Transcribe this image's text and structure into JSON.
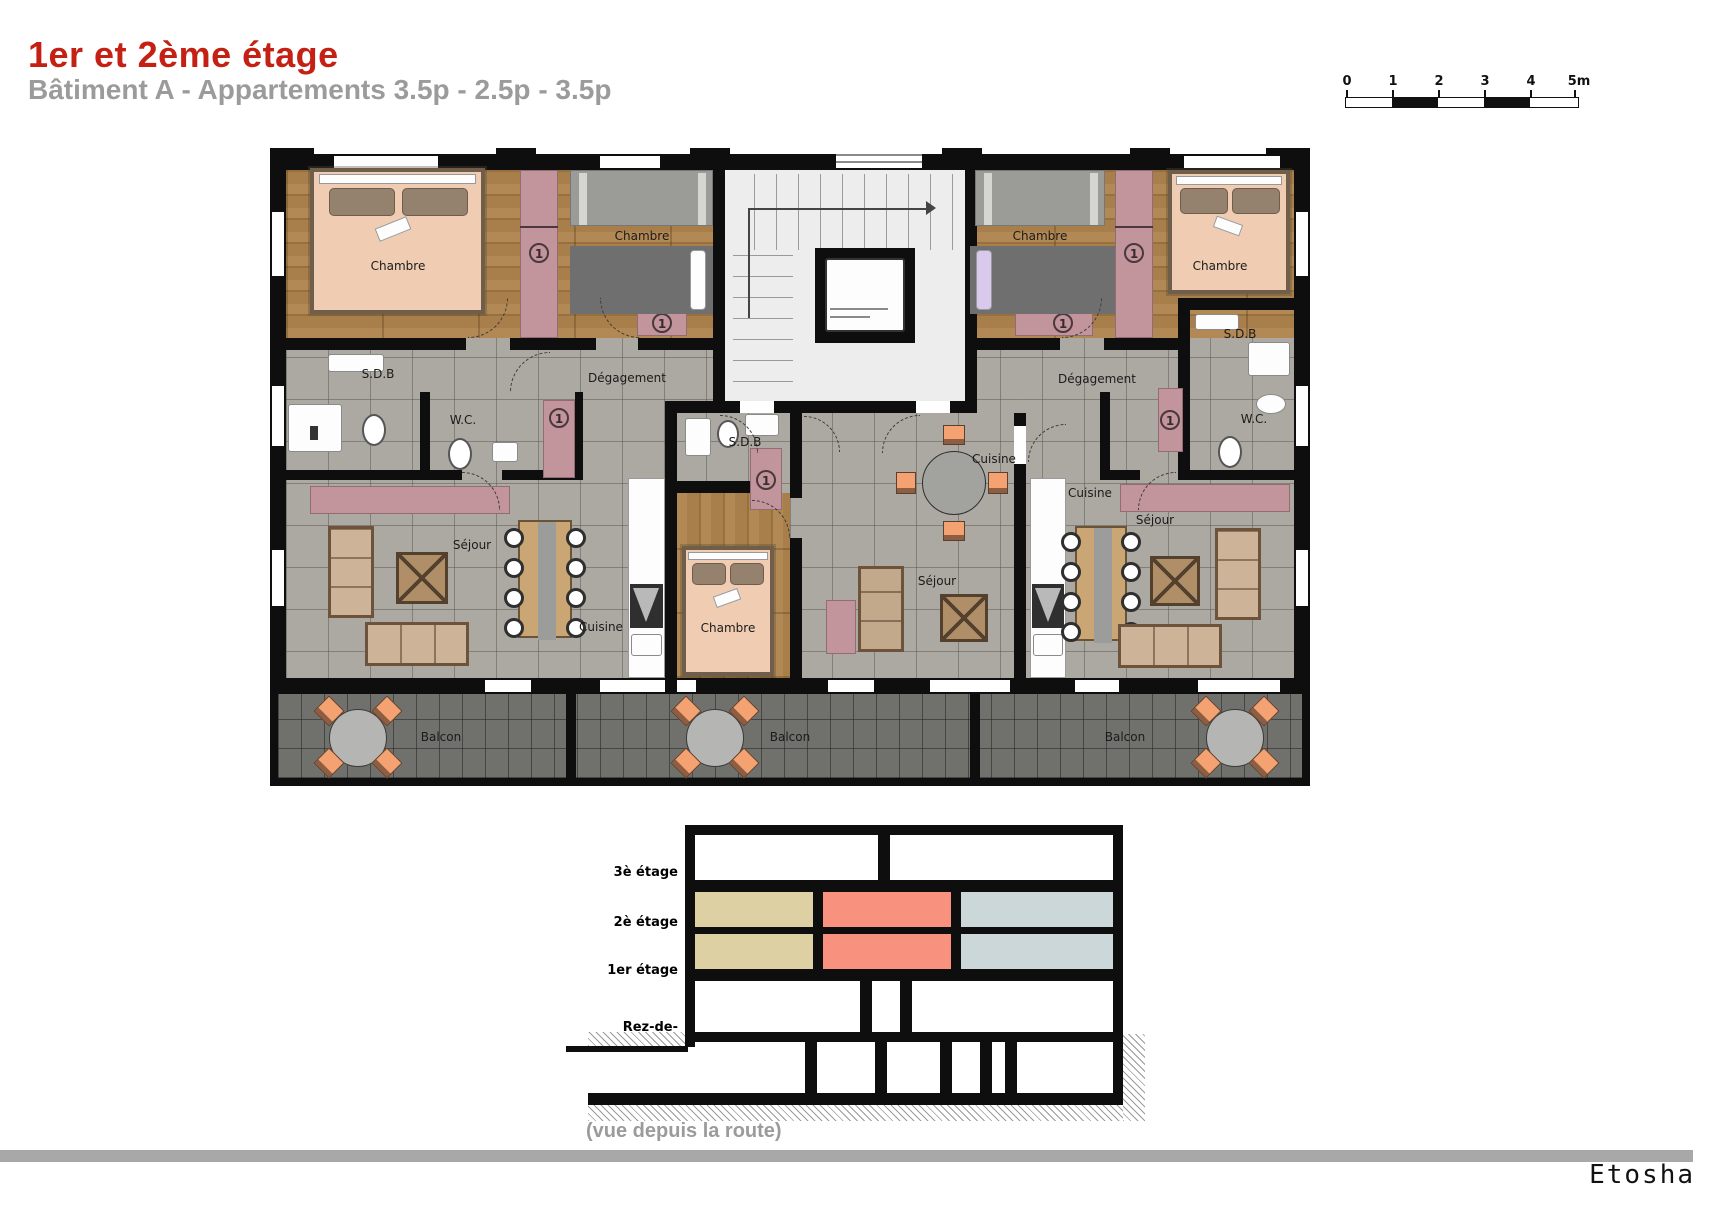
{
  "header": {
    "title": "1er et 2ème étage",
    "subtitle": "Bâtiment A - Appartements 3.5p - 2.5p - 3.5p"
  },
  "scale_bar": {
    "ticks": [
      "0",
      "1",
      "2",
      "3",
      "4",
      "5m"
    ]
  },
  "plan": {
    "labels": {
      "chambre": "Chambre",
      "sdb": "S.D.B",
      "wc": "W.C.",
      "degagement": "Dégagement",
      "sejour": "Séjour",
      "cuisine": "Cuisine",
      "balcon": "Balcon"
    },
    "closet_number": "1"
  },
  "section": {
    "floors": [
      "3è étage",
      "2è étage",
      "1er étage",
      "Rez-de-chaussée"
    ],
    "caption": "(vue depuis la route)",
    "legend_colors": {
      "left_apartment": "#ddd0a2",
      "middle_apartment": "#f9917f",
      "right_apartment": "#ccd7d9"
    }
  },
  "footer": {
    "brand": "Etosha"
  },
  "palette": {
    "title_red": "#c42114",
    "subtitle_gray": "#9b9b9b",
    "closet_pink": "#c2949c",
    "wall_black": "#0e0e0e",
    "wood_floor": "#a87e4b",
    "tile_floor": "#aca9a2",
    "balcony_tile": "#70706c",
    "chair_orange": "#f5a273"
  }
}
